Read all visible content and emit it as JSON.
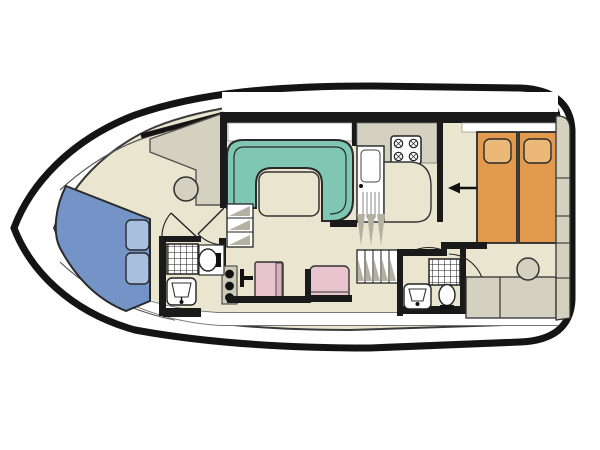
{
  "figure": {
    "type": "floorplan",
    "subject": "motor-cruiser-boat-deck-plan",
    "orientation": "bow-left-stern-right",
    "rooms": [
      {
        "name": "bow-cabin",
        "furniture": [
          "double-berth-blue",
          "two-pillows"
        ]
      },
      {
        "name": "forward-bathroom",
        "furniture": [
          "shower",
          "toilet",
          "washbasin"
        ]
      },
      {
        "name": "helm-station",
        "furniture": [
          "console",
          "helm-seat"
        ]
      },
      {
        "name": "saloon",
        "furniture": [
          "u-shaped-dinette-teal",
          "table"
        ]
      },
      {
        "name": "galley",
        "furniture": [
          "four-burner-stove",
          "sink-with-drainer",
          "counter"
        ]
      },
      {
        "name": "mid-cabin",
        "furniture": [
          "berth-pink-left",
          "berth-pink-right",
          "unit-with-three-knobs",
          "t-handle-fitting"
        ]
      },
      {
        "name": "aft-bathroom",
        "furniture": [
          "shower",
          "toilet",
          "washbasin"
        ]
      },
      {
        "name": "aft-cabin",
        "furniture": [
          "single-berth-orange-left",
          "single-berth-orange-right",
          "two-pillows",
          "stool",
          "cabinets",
          "side-lockers",
          "entry-arrow"
        ]
      }
    ],
    "stairs": [
      "forward-companionway-steps",
      "aft-companionway-steps"
    ],
    "doors": [
      "forward-bathroom-door",
      "helm-passage-door",
      "aft-cabin-door",
      "aft-bathroom-door"
    ]
  },
  "colors": {
    "hull": "#141414",
    "wall": "#1a1a1a",
    "floor": "#e9e5cf",
    "white": "#ffffff",
    "gray": "#d5d1c1",
    "grayDark": "#b5b1a1",
    "teal": "#7fc7b2",
    "orange": "#e29a4e",
    "orangeLight": "#ecb877",
    "pink": "#e7c3ce",
    "pinkDark": "#d9afbc",
    "blue": "#7494c8",
    "blueLight": "#a9bfdf",
    "line": "#2a2a2a"
  }
}
